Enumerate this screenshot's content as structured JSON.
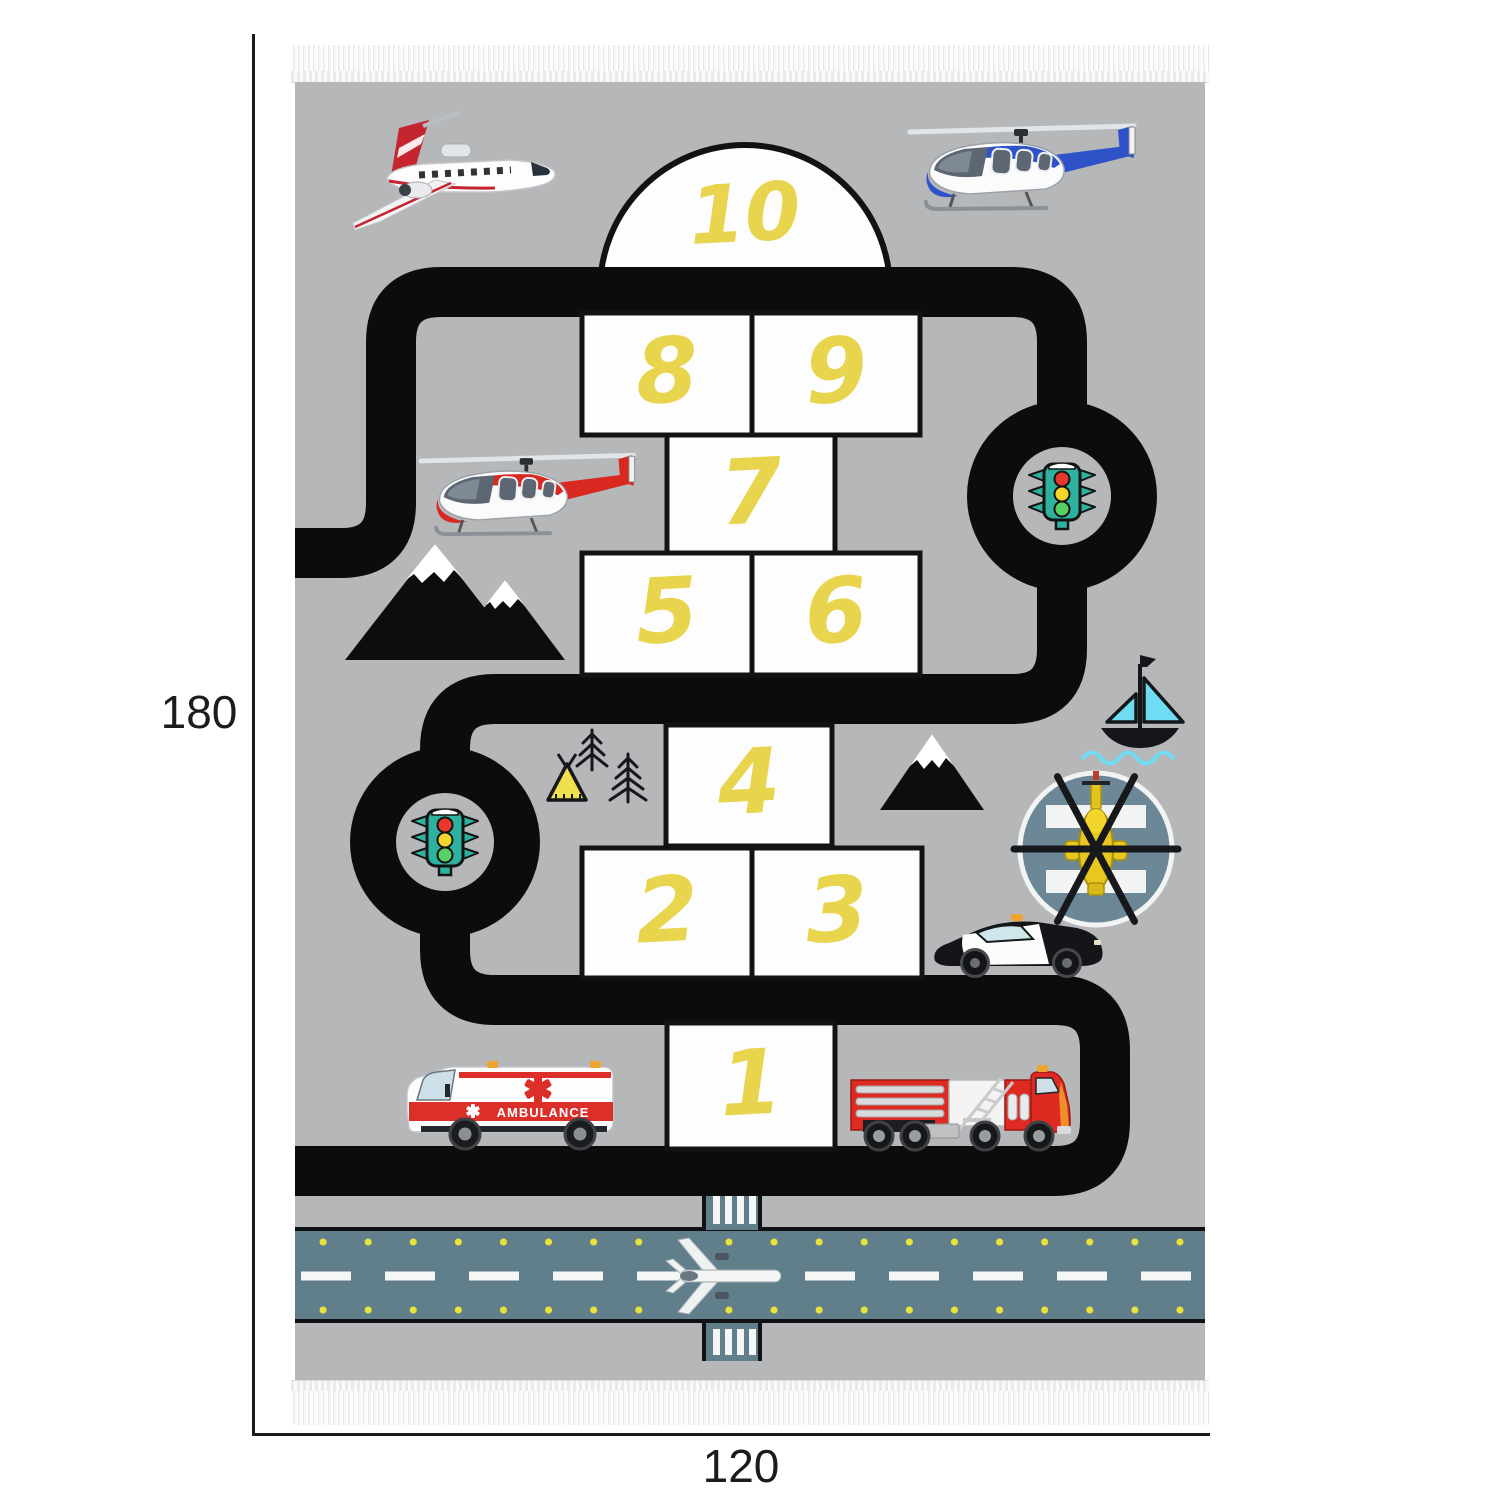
{
  "dimension_annotations": {
    "height_label": "180",
    "width_label": "120"
  },
  "rug": {
    "hopscotch": {
      "cells": [
        {
          "value": "10"
        },
        {
          "value": "8"
        },
        {
          "value": "9"
        },
        {
          "value": "7"
        },
        {
          "value": "5"
        },
        {
          "value": "6"
        },
        {
          "value": "4"
        },
        {
          "value": "2"
        },
        {
          "value": "3"
        },
        {
          "value": "1"
        }
      ]
    },
    "ambulance_label": "AMBULANCE",
    "icons": [
      "jet-airplane-icon",
      "helicopter-blue-icon",
      "helicopter-red-icon",
      "traffic-light-icon",
      "mountains-icon",
      "mountain-single-icon",
      "pine-trees-icon",
      "tent-icon",
      "sailboat-icon",
      "helipad-helicopter-icon",
      "police-car-icon",
      "ambulance-icon",
      "fire-truck-icon",
      "runway-airplane-icon"
    ],
    "colors": {
      "rug_gray": "#b5b7b9",
      "road_black": "#0c0c0c",
      "cell_white": "#fdfdfd",
      "number_yellow": "#e9d54d",
      "runway_slate": "#617e8b",
      "helipad_slate": "#6c8896",
      "traffic_light_teal": "#2eb2a0",
      "accent_red": "#dd2f2a",
      "boat_cyan": "#6edcf2",
      "runway_dot_yellow": "#e8e33b"
    }
  }
}
